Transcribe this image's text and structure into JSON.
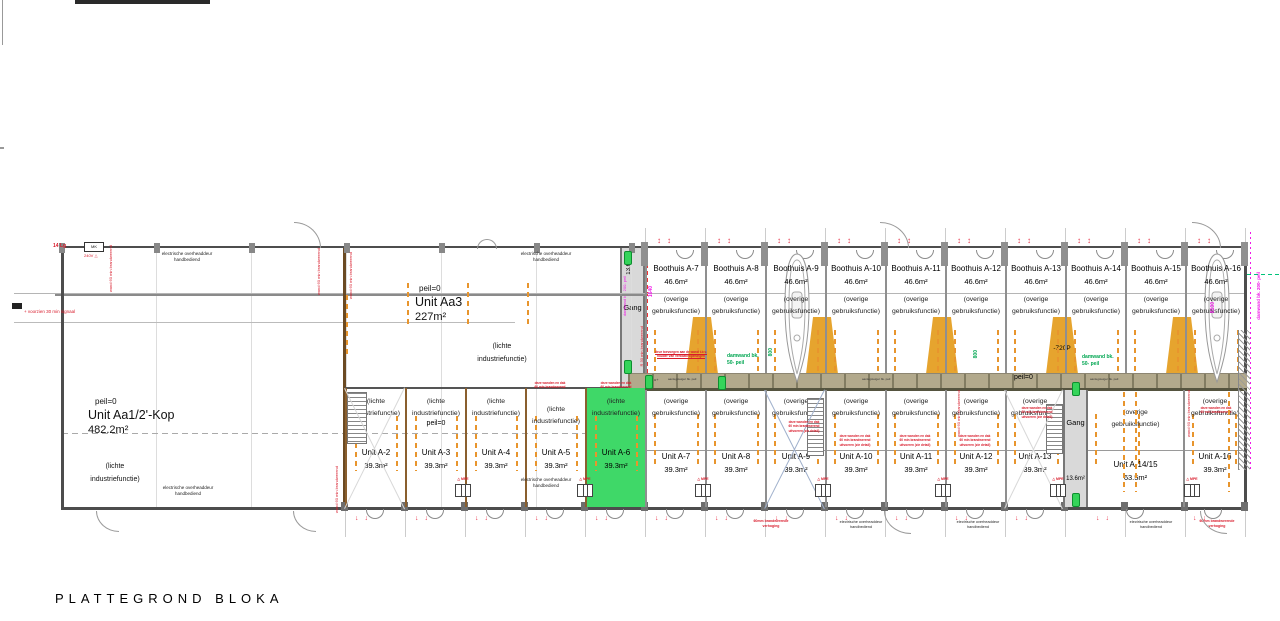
{
  "title": "PLATTEGROND BLOKA",
  "labels": {
    "overige_1": "(overige",
    "overige_2": "gebruiksfunctie)",
    "lichte_1": "(lichte",
    "lichte_2": "industriefunctie)",
    "peil": "peil=0",
    "door_1": "electrische overheaddeur",
    "door_2": "handbediend",
    "gang": "Gang",
    "gang_area": "13.6m²",
    "u_plus": "u+",
    "deck": "aanlegsteiger bk. peil"
  },
  "hall": {
    "kop": {
      "peil": "peil=0",
      "name": "Unit Aa1/2'-Kop",
      "area": "482.2m²"
    },
    "aa3": {
      "peil": "peil=0",
      "name": "Unit Aa3",
      "area": "227m²"
    }
  },
  "boathouses": [
    {
      "name": "Boothuis A-7",
      "area": "46.6m²"
    },
    {
      "name": "Boothuis A-8",
      "area": "46.6m²"
    },
    {
      "name": "Boothuis A-9",
      "area": "46.6m²"
    },
    {
      "name": "Boothuis A-10",
      "area": "46.6m²"
    },
    {
      "name": "Boothuis A-11",
      "area": "46.6m²"
    },
    {
      "name": "Boothuis A-12",
      "area": "46.6m²"
    },
    {
      "name": "Boothuis A-13",
      "area": "46.6m²"
    },
    {
      "name": "Boothuis A-14",
      "area": "46.6m²"
    },
    {
      "name": "Boothuis A-15",
      "area": "46.6m²"
    },
    {
      "name": "Boothuis A-16",
      "area": "46.6m²"
    }
  ],
  "units_small": [
    {
      "name": "Unit A-2",
      "area": "39.3m²"
    },
    {
      "name": "Unit A-3",
      "area": "39.3m²"
    },
    {
      "name": "Unit A-4",
      "area": "39.3m²"
    },
    {
      "name": "Unit A-5",
      "area": "39.3m²"
    },
    {
      "name": "Unit A-6",
      "area": "39.3m²"
    }
  ],
  "units_bottom": [
    {
      "name": "Unit A-7",
      "area": "39.3m²"
    },
    {
      "name": "Unit A-8",
      "area": "39.3m²"
    },
    {
      "name": "Unit A-9",
      "area": "39.3m²"
    },
    {
      "name": "Unit A-10",
      "area": "39.3m²"
    },
    {
      "name": "Unit A-11",
      "area": "39.3m²"
    },
    {
      "name": "Unit A-12",
      "area": "39.3m²"
    },
    {
      "name": "Unit A-13",
      "area": "39.3m²"
    },
    {
      "name": "Unit A-14/15",
      "area": "63.5m²"
    },
    {
      "name": "Unit A-16",
      "area": "39.3m²"
    }
  ],
  "dims": {
    "d800": "800",
    "d1640": "1640",
    "d8100": "8100",
    "damwand50_1": "damwand bk.",
    "damwand50_2": "50- peil",
    "damwand200": "damwand bk. 200- peil",
    "ramp": "-720P"
  },
  "notes": {
    "r30": "R 30 min brandwerend",
    "w60": "wand 60 min brandwerend",
    "signal": "+ voorzien 30 min signaal",
    "lg": "14 Lg",
    "mk": "MK",
    "v240": "240V △",
    "mpe": "△ MPE",
    "quay_1": "deur toevoegen aan de wand t.b.v.",
    "quay_2": "houder van ventilatieopeningen",
    "block_1": "deze wanden en dak",
    "block_2": "60 min brandwerend",
    "block_3": "uitvoeren (zie detail)",
    "below_red_1": "60mm brandwerende",
    "below_red_2": "verhoging"
  },
  "colors": {
    "highlight_green": "#3fd868",
    "ramp_orange": "#e6a42e",
    "quay_tan": "#b2a98c",
    "annotation_red": "#d81a2a",
    "annotation_magenta": "#f018e8",
    "annotation_green": "#00a651",
    "marker_orange": "#e8952d"
  }
}
